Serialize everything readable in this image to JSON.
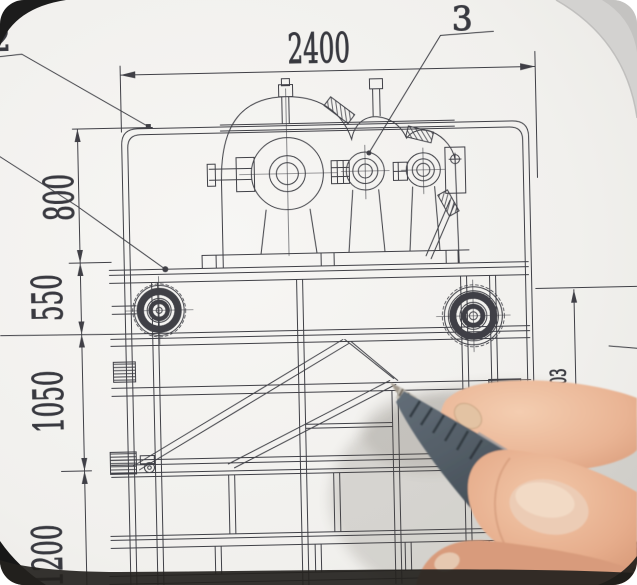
{
  "photo": {
    "paper_color": "#f2f1ee",
    "ink_color": "#2e2f36",
    "corner_shadow_color": "#1c1c1c",
    "paper_edge_gray": "#d3d2d0",
    "pen_color": "#49535c",
    "skin_color": "#e9b494"
  },
  "drawing": {
    "dimensions": {
      "top_width": "2400",
      "left_chain": [
        "800",
        "550",
        "1050",
        "1200"
      ],
      "right_height": "1403"
    },
    "callouts": {
      "upper_left": "2",
      "upper_right": "3"
    }
  }
}
